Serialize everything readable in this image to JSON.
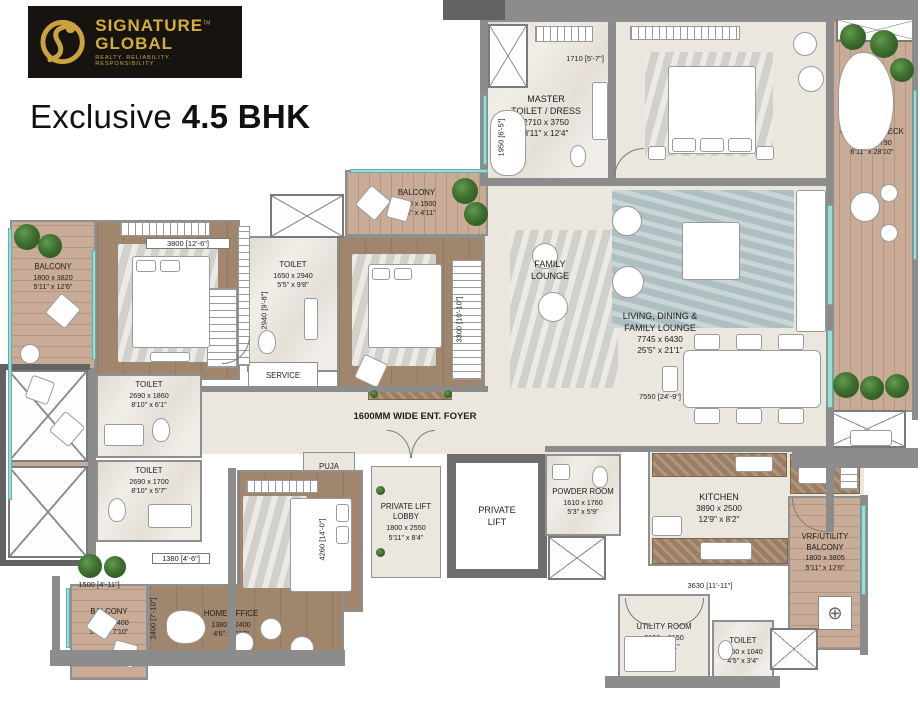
{
  "brand": {
    "line1": "SIGNATURE",
    "line2": "GLOBAL",
    "tm": "TM",
    "tagline": "REALTY. RELIABILITY. RESPONSIBILITY."
  },
  "title": {
    "regular": "Exclusive ",
    "bold": "4.5 BHK"
  },
  "rooms": {
    "master_toilet": {
      "name": "MASTER\nTOILET / DRESS",
      "metric": "2710 x 3750",
      "imperial": "8'11\" x 12'4\""
    },
    "master_bedroom": {
      "name": "MASTER\nBEDROOM",
      "metric": "5070 x 3750",
      "imperial": "16'8\" x 12'4\""
    },
    "outdoor_deck": {
      "name": "OUTDOOR DECK",
      "metric": "2100 x 8790",
      "imperial": "6'11\" x 28'10\""
    },
    "balcony_left": {
      "name": "BALCONY",
      "metric": "1800 x 3820",
      "imperial": "5'11\" x 12'6\""
    },
    "bedroom2": {
      "name": "BEDROOM 2",
      "metric": "3945 x 3825",
      "imperial": "12'11\" x 12'7\""
    },
    "balcony_top": {
      "name": "BALCONY",
      "metric": "3490 x 1500",
      "imperial": "11'5\" x 4'11\""
    },
    "toilet_mid": {
      "name": "TOILET",
      "metric": "1650 x 2940",
      "imperial": "5'5\" x 9'8\""
    },
    "bedroom1": {
      "name": "BEDROOM 1",
      "metric": "3950 x 3500",
      "imperial": "12'11\" x 11'6\""
    },
    "family_lounge": {
      "name": "FAMILY\nLOUNGE"
    },
    "living_dining": {
      "name": "LIVING, DINING &\nFAMILY LOUNGE",
      "metric": "7745 x 6430",
      "imperial": "25'5\" x 21'1\""
    },
    "toilet_upper_left": {
      "name": "TOILET",
      "metric": "2690 x 1860",
      "imperial": "8'10\" x 6'1\""
    },
    "toilet_lower_left": {
      "name": "TOILET",
      "metric": "2690 x 1700",
      "imperial": "8'10\" x 5'7\""
    },
    "service": {
      "name": "SERVICE"
    },
    "foyer": {
      "name": "1600MM WIDE ENT. FOYER"
    },
    "puja": {
      "name": "PUJA"
    },
    "junior_master": {
      "name": "JUNIOR MASTER\nBEDROOM",
      "metric": "3820 x 4260",
      "imperial": "12'6\" x 14'0\""
    },
    "private_lift_lobby": {
      "name": "PRIVATE LIFT\nLOBBY",
      "metric": "1800 x 2550",
      "imperial": "5'11\" x 8'4\""
    },
    "private_lift": {
      "name": "PRIVATE\nLIFT"
    },
    "powder_room": {
      "name": "POWDER ROOM",
      "metric": "1610 x 1760",
      "imperial": "5'3\" x 5'9\""
    },
    "kitchen": {
      "name": "KITCHEN",
      "metric": "3890 x 2500",
      "imperial": "12'9\" x 8'2\""
    },
    "vrf_balcony": {
      "name": "VRF/UTILITY\nBALCONY",
      "metric": "1800 x 3805",
      "imperial": "5'11\" x 12'6\""
    },
    "balcony_bottom": {
      "name": "BALCONY",
      "metric": "1800 x 2400",
      "imperial": "5'11\" x 7'10\""
    },
    "home_office": {
      "name": "HOME OFFICE",
      "metric": "1380 x 2400",
      "imperial": "4'6\" x 7'10\""
    },
    "utility_room": {
      "name": "UTILITY ROOM",
      "metric": "2190 x 2150",
      "imperial": "7'2\" x 7'1\""
    },
    "toilet_utility": {
      "name": "TOILET",
      "metric": "1350 x 1040",
      "imperial": "4'5\" x 3'4\""
    }
  },
  "dims": {
    "d1710": "1710 [5'-7\"]",
    "d1950": "1950 [6'-5\"]",
    "d3800": "3800 [12'-6\"]",
    "d2940": "2940 [9'-8\"]",
    "d3300": "3300 [10'-10\"]",
    "d7550": "7550 [24'-9\"]",
    "d4260": "4260 [14'-0\"]",
    "d1380": "1380 [4'-6\"]",
    "d1500": "1500 [4'-11\"]",
    "d2400": "2400 [7'-10\"]",
    "d3630": "3630 [11'-11\"]"
  },
  "colors": {
    "gold": "#d4af37",
    "logo_bg": "#171310",
    "wall": "#8c8c8c",
    "window": "#9edbd6",
    "wood_floor": "#a0866c",
    "deck_floor": "#c9ac97",
    "plant_green": "#3f7030",
    "text": "#1c1c1c"
  }
}
